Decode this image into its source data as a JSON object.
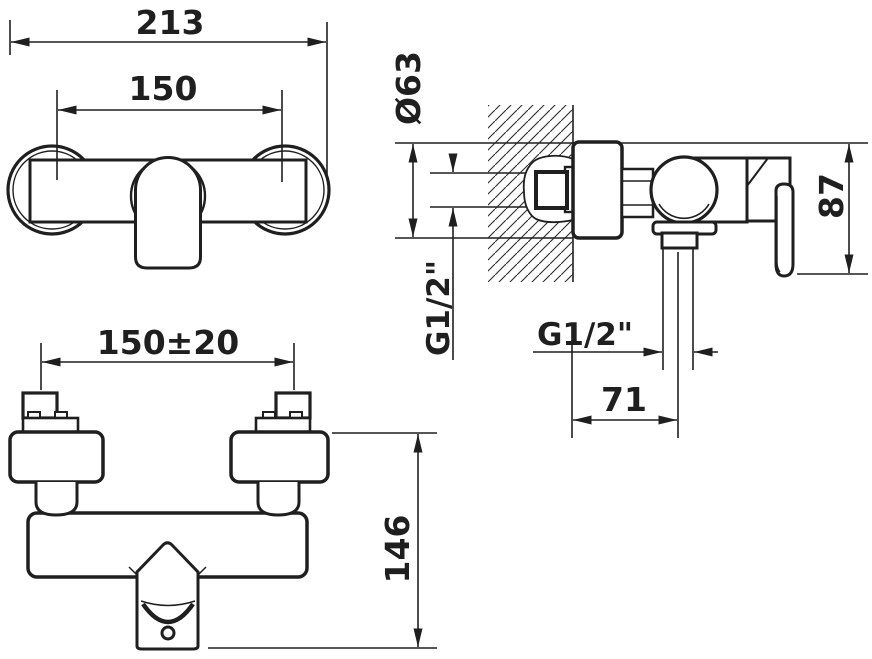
{
  "drawing": {
    "type": "technical-dimension-drawing",
    "subject": "Wall-mounted single-lever shower mixer installation drawing",
    "units": "mm",
    "views": [
      "front view",
      "side view",
      "bottom view"
    ]
  },
  "labels": {
    "front_overall_width": "213",
    "front_connection_centers": "150",
    "side_escutcheon_diameter": "Ø63",
    "side_wall_thread": "G1/2\"",
    "side_outlet_thread": "G1/2\"",
    "side_height": "87",
    "side_outlet_projection": "71",
    "bottom_centers_tolerance": "150±20",
    "bottom_depth": "146"
  }
}
